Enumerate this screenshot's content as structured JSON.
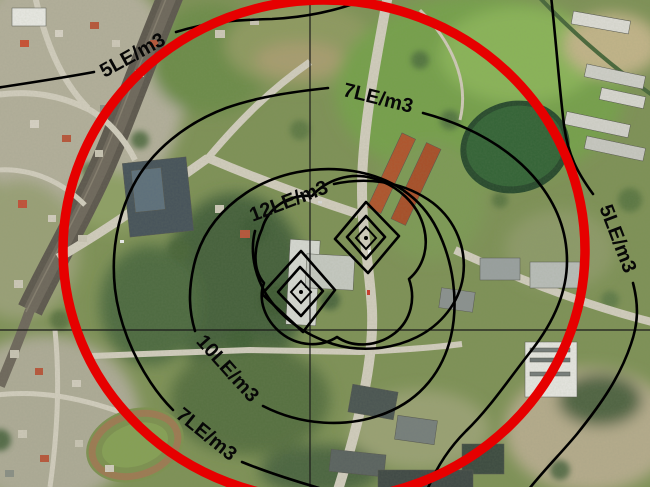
{
  "map": {
    "title": "Odour dispersion contour map over aerial photo",
    "unit": "LE/m3",
    "contour_levels": [
      5,
      7,
      10,
      12
    ],
    "labels": {
      "nw5": "5LE/m3",
      "n7": "7LE/m3",
      "c12": "12LE/m3",
      "sw10": "10LE/m3",
      "sw7": "7LE/m3",
      "e5": "5LE/m3"
    },
    "colors": {
      "impact_zone_circle": "#e60000",
      "contour_line": "#000000",
      "crosshair_line": "#1a1a1a",
      "pond_water": "#2f6134"
    },
    "markers": {
      "source_marker_icon": "diamond-dot",
      "source_marker_count": 2
    }
  }
}
